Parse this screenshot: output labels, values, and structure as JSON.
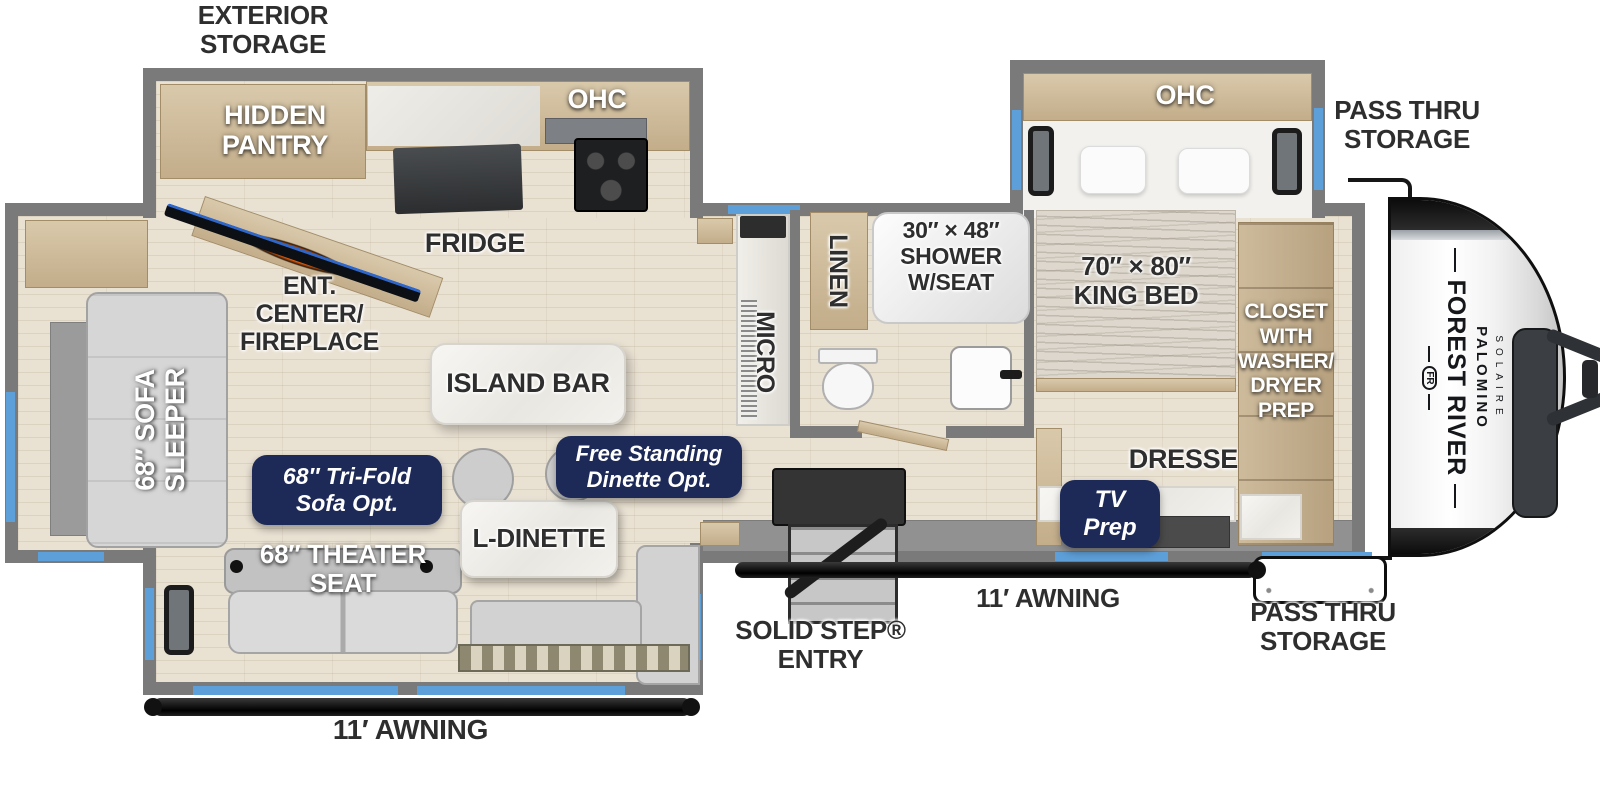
{
  "colors": {
    "wall": "#7a7a7a",
    "floor": "#e9e1d2",
    "cabinet": "#cdbb9c",
    "marble": "#f2f1ed",
    "navy_badge": "#1d2957",
    "window_blue": "#5d9fd8",
    "awning_black": "#111111",
    "label_dark": "#2e2e2e",
    "label_white": "#ffffff",
    "fireplace_glow": "#f06008"
  },
  "labels": {
    "exterior_storage": "EXTERIOR\nSTORAGE",
    "hidden_pantry": "HIDDEN\nPANTRY",
    "kitchen_ohc": "OHC",
    "fridge": "FRIDGE",
    "ent_center": "ENT.\nCENTER/\nFIREPLACE",
    "island_bar": "ISLAND BAR",
    "sofa_sleeper": "68″ SOFA\nSLEEPER",
    "trifold_sofa_opt": "68″ Tri-Fold\nSofa Opt.",
    "theater_seat": "68″ THEATER\nSEAT",
    "l_dinette": "L-DINETTE",
    "free_standing_dinette_opt": "Free Standing\nDinette Opt.",
    "micro": "MICRO",
    "linen": "LINEN",
    "shower": "30″ × 48″\nSHOWER\nW/SEAT",
    "king_bed": "70″ × 80″\nKING BED",
    "bedroom_ohc": "OHC",
    "pass_thru_storage_top": "PASS THRU\nSTORAGE",
    "closet": "CLOSET\nWITH\nWASHER/\nDRYER\nPREP",
    "dresser": "DRESSER",
    "tv_prep": "TV\nPrep",
    "awning_right": "11′ AWNING",
    "awning_left": "11′ AWNING",
    "pass_thru_storage_bottom": "PASS THRU\nSTORAGE",
    "solid_step_entry": "SOLID STEP®\nENTRY"
  },
  "brand": {
    "manufacturer": "FOREST RIVER",
    "model": "PALOMINO",
    "trim": "SOLAIRE",
    "emblem": "FR"
  }
}
